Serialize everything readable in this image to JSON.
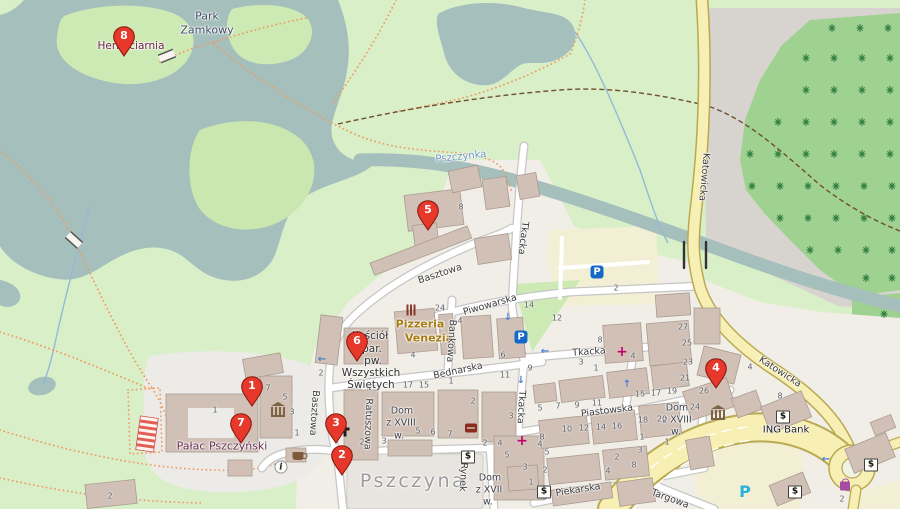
{
  "map": {
    "town": "Pszczyna",
    "colors": {
      "water": "#a5bfbc",
      "park": "#d8efc8",
      "island": "#cdeab4",
      "scrub": "#c9e7ae",
      "forest": "#9fd191",
      "tree": "#2e7b3f",
      "bare_gray": "#d7d3ce",
      "town_bg": "#f1eee8",
      "building": "#d0c0b6",
      "road_white": "#ffffff",
      "road_casing": "#c6c6c6",
      "road_main": "#f7efb4",
      "road_main_casing": "#b9a94f",
      "parking_lot": "#f3efd5",
      "square": "#e8e5e0",
      "marker_red": "#e6392b",
      "path_dotted": "#ef9b62",
      "path_dashed": "#6f4f2f"
    },
    "markers": [
      {
        "number": "1",
        "x": 252,
        "y": 407,
        "name": "map-marker-1"
      },
      {
        "number": "2",
        "x": 342,
        "y": 476,
        "name": "map-marker-2"
      },
      {
        "number": "3",
        "x": 336,
        "y": 444,
        "name": "map-marker-3"
      },
      {
        "number": "4",
        "x": 716,
        "y": 389,
        "name": "map-marker-4"
      },
      {
        "number": "5",
        "x": 428,
        "y": 231,
        "name": "map-marker-5"
      },
      {
        "number": "6",
        "x": 357,
        "y": 362,
        "name": "map-marker-6"
      },
      {
        "number": "7",
        "x": 241,
        "y": 444,
        "name": "map-marker-7"
      },
      {
        "number": "8",
        "x": 124,
        "y": 57,
        "name": "map-marker-8"
      }
    ],
    "street_labels": [
      {
        "text": "Basztowa",
        "x": 440,
        "y": 274,
        "rotate": -18
      },
      {
        "text": "Basztowa",
        "x": 314,
        "y": 413,
        "rotate": 94
      },
      {
        "text": "Ratuszowa",
        "x": 368,
        "y": 424,
        "rotate": 92
      },
      {
        "text": "Bednarska",
        "x": 458,
        "y": 371,
        "rotate": -12
      },
      {
        "text": "Bankowa",
        "x": 451,
        "y": 341,
        "rotate": 94
      },
      {
        "text": "Piwowarska",
        "x": 490,
        "y": 305,
        "rotate": -16
      },
      {
        "text": "Tkacka",
        "x": 523,
        "y": 238,
        "rotate": 97
      },
      {
        "text": "Tkacka",
        "x": 589,
        "y": 352,
        "rotate": -4
      },
      {
        "text": "Tkacka",
        "x": 521,
        "y": 407,
        "rotate": 93
      },
      {
        "text": "Piastowska",
        "x": 607,
        "y": 411,
        "rotate": -7
      },
      {
        "text": "Piekarska",
        "x": 578,
        "y": 490,
        "rotate": -9
      },
      {
        "text": "Rynek",
        "x": 463,
        "y": 477,
        "rotate": 93
      },
      {
        "text": "Targowa",
        "x": 670,
        "y": 499,
        "rotate": 20
      },
      {
        "text": "Katowicka",
        "x": 704,
        "y": 177,
        "rotate": 95
      },
      {
        "text": "Katowicka",
        "x": 780,
        "y": 372,
        "rotate": 33
      }
    ],
    "place_labels": [
      {
        "text": "Park",
        "x": 207,
        "y": 16,
        "color": "#414d68",
        "size": 11
      },
      {
        "text": "Zamkowy",
        "x": 207,
        "y": 30,
        "color": "#414d68",
        "size": 11
      },
      {
        "text": "Herbaciarnia",
        "x": 131,
        "y": 46,
        "color": "#6e2245",
        "size": 10.5
      },
      {
        "text": "Pszczynka",
        "x": 461,
        "y": 157,
        "color": "#6f96c2",
        "size": 10,
        "rotate": -6
      },
      {
        "text": "Pizzeria",
        "x": 420,
        "y": 324,
        "color": "#a87b10",
        "size": 11,
        "bold": true
      },
      {
        "text": "Venezia",
        "x": 429,
        "y": 338,
        "color": "#a87b10",
        "size": 11,
        "bold": true
      },
      {
        "text": "Kościół",
        "x": 370,
        "y": 336,
        "color": "#2f2f2f",
        "size": 10.5
      },
      {
        "text": "par.",
        "x": 372,
        "y": 349,
        "color": "#2f2f2f",
        "size": 10.5
      },
      {
        "text": "pw.",
        "x": 373,
        "y": 361,
        "color": "#2f2f2f",
        "size": 10.5
      },
      {
        "text": "Wszystkich",
        "x": 371,
        "y": 373,
        "color": "#2f2f2f",
        "size": 10.5
      },
      {
        "text": "Świętych",
        "x": 371,
        "y": 385,
        "color": "#2f2f2f",
        "size": 10.5
      },
      {
        "text": "Pałac Pszczyński",
        "x": 222,
        "y": 446,
        "color": "#692c4e",
        "size": 11
      },
      {
        "text": "Dom",
        "x": 402,
        "y": 411,
        "color": "#3d3d46",
        "size": 9.5
      },
      {
        "text": "z XVIII",
        "x": 401,
        "y": 423,
        "color": "#3d3d46",
        "size": 9.5
      },
      {
        "text": "w.",
        "x": 399,
        "y": 436,
        "color": "#3d3d46",
        "size": 9.5
      },
      {
        "text": "Dom",
        "x": 677,
        "y": 408,
        "color": "#3d3d46",
        "size": 9.5
      },
      {
        "text": "z XVIII",
        "x": 677,
        "y": 420,
        "color": "#3d3d46",
        "size": 9.5
      },
      {
        "text": "w.",
        "x": 676,
        "y": 432,
        "color": "#3d3d46",
        "size": 9.5
      },
      {
        "text": "Dom",
        "x": 490,
        "y": 478,
        "color": "#3d3d46",
        "size": 9.5
      },
      {
        "text": "z XVII",
        "x": 489,
        "y": 490,
        "color": "#3d3d46",
        "size": 9.5
      },
      {
        "text": "w.",
        "x": 488,
        "y": 502,
        "color": "#3d3d46",
        "size": 9.5
      },
      {
        "text": "ING Bank",
        "x": 786,
        "y": 430,
        "color": "#1a1a1a",
        "size": 10
      },
      {
        "text": "Pszczyna",
        "x": 413,
        "y": 481,
        "color": "#9b9b9b",
        "size": 19,
        "ls": 2.5
      }
    ],
    "house_numbers": [
      {
        "text": "8",
        "x": 461,
        "y": 207
      },
      {
        "text": "24",
        "x": 440,
        "y": 308
      },
      {
        "text": "14",
        "x": 529,
        "y": 305
      },
      {
        "text": "12",
        "x": 557,
        "y": 318
      },
      {
        "text": "2",
        "x": 616,
        "y": 288
      },
      {
        "text": "8",
        "x": 600,
        "y": 340
      },
      {
        "text": "3",
        "x": 581,
        "y": 362
      },
      {
        "text": "1",
        "x": 596,
        "y": 368
      },
      {
        "text": "4",
        "x": 460,
        "y": 321
      },
      {
        "text": "6",
        "x": 503,
        "y": 355
      },
      {
        "text": "9",
        "x": 530,
        "y": 368
      },
      {
        "text": "11",
        "x": 505,
        "y": 375
      },
      {
        "text": "4",
        "x": 413,
        "y": 355
      },
      {
        "text": "27",
        "x": 683,
        "y": 327
      },
      {
        "text": "25",
        "x": 687,
        "y": 343
      },
      {
        "text": "23",
        "x": 688,
        "y": 362
      },
      {
        "text": "21",
        "x": 685,
        "y": 378
      },
      {
        "text": "15",
        "x": 640,
        "y": 394
      },
      {
        "text": "17",
        "x": 656,
        "y": 393
      },
      {
        "text": "19",
        "x": 672,
        "y": 391
      },
      {
        "text": "18",
        "x": 643,
        "y": 420
      },
      {
        "text": "20",
        "x": 662,
        "y": 419
      },
      {
        "text": "24",
        "x": 695,
        "y": 407
      },
      {
        "text": "26",
        "x": 704,
        "y": 391
      },
      {
        "text": "2",
        "x": 720,
        "y": 362
      },
      {
        "text": "4",
        "x": 750,
        "y": 367
      },
      {
        "text": "8",
        "x": 780,
        "y": 396
      },
      {
        "text": "4",
        "x": 633,
        "y": 356
      },
      {
        "text": "17",
        "x": 408,
        "y": 385
      },
      {
        "text": "15",
        "x": 424,
        "y": 385
      },
      {
        "text": "1",
        "x": 451,
        "y": 381
      },
      {
        "text": "2",
        "x": 473,
        "y": 401
      },
      {
        "text": "3",
        "x": 511,
        "y": 416
      },
      {
        "text": "2",
        "x": 362,
        "y": 442
      },
      {
        "text": "3",
        "x": 384,
        "y": 441
      },
      {
        "text": "5",
        "x": 418,
        "y": 431
      },
      {
        "text": "6",
        "x": 433,
        "y": 432
      },
      {
        "text": "7",
        "x": 450,
        "y": 434
      },
      {
        "text": "2",
        "x": 321,
        "y": 373
      },
      {
        "text": "5",
        "x": 540,
        "y": 408
      },
      {
        "text": "7",
        "x": 558,
        "y": 406
      },
      {
        "text": "9",
        "x": 577,
        "y": 405
      },
      {
        "text": "11",
        "x": 597,
        "y": 403
      },
      {
        "text": "10",
        "x": 567,
        "y": 429
      },
      {
        "text": "12",
        "x": 584,
        "y": 428
      },
      {
        "text": "14",
        "x": 601,
        "y": 427
      },
      {
        "text": "16",
        "x": 617,
        "y": 426
      },
      {
        "text": "8",
        "x": 542,
        "y": 437
      },
      {
        "text": "5",
        "x": 547,
        "y": 452
      },
      {
        "text": "3",
        "x": 640,
        "y": 450
      },
      {
        "text": "1",
        "x": 667,
        "y": 442
      },
      {
        "text": "2",
        "x": 617,
        "y": 457
      },
      {
        "text": "4",
        "x": 608,
        "y": 471
      },
      {
        "text": "8",
        "x": 634,
        "y": 465
      },
      {
        "text": "9",
        "x": 545,
        "y": 497
      },
      {
        "text": "2",
        "x": 485,
        "y": 443
      },
      {
        "text": "4",
        "x": 500,
        "y": 443
      },
      {
        "text": "5",
        "x": 507,
        "y": 455
      },
      {
        "text": "4",
        "x": 540,
        "y": 444
      },
      {
        "text": "3",
        "x": 525,
        "y": 467
      },
      {
        "text": "2",
        "x": 545,
        "y": 470
      },
      {
        "text": "1",
        "x": 531,
        "y": 482
      },
      {
        "text": "1",
        "x": 215,
        "y": 410
      },
      {
        "text": "7",
        "x": 268,
        "y": 388
      },
      {
        "text": "5",
        "x": 285,
        "y": 397
      },
      {
        "text": "3",
        "x": 292,
        "y": 412
      },
      {
        "text": "1",
        "x": 297,
        "y": 433
      },
      {
        "text": "2",
        "x": 110,
        "y": 496
      },
      {
        "text": "1",
        "x": 642,
        "y": 437
      },
      {
        "text": "2",
        "x": 842,
        "y": 499
      }
    ],
    "poi_icons": [
      {
        "cls": "parking",
        "glyph": "P",
        "x": 597,
        "y": 272,
        "name": "parking-icon"
      },
      {
        "cls": "parking",
        "glyph": "P",
        "x": 521,
        "y": 337,
        "name": "parking-icon"
      },
      {
        "cls": "parking-free",
        "glyph": "P",
        "x": 745,
        "y": 492,
        "name": "free-parking-icon"
      },
      {
        "cls": "bank",
        "glyph": "$",
        "x": 783,
        "y": 417,
        "name": "bank-icon"
      },
      {
        "cls": "bank",
        "glyph": "$",
        "x": 468,
        "y": 457,
        "name": "bank-icon"
      },
      {
        "cls": "bank",
        "glyph": "$",
        "x": 544,
        "y": 492,
        "name": "bank-icon"
      },
      {
        "cls": "bank",
        "glyph": "$",
        "x": 795,
        "y": 492,
        "name": "atm-icon"
      },
      {
        "cls": "bank",
        "glyph": "$",
        "x": 871,
        "y": 465,
        "name": "atm-icon"
      },
      {
        "cls": "pharmacy",
        "glyph": "+",
        "x": 522,
        "y": 441,
        "name": "pharmacy-icon"
      },
      {
        "cls": "pharmacy",
        "glyph": "+",
        "x": 622,
        "y": 352,
        "name": "pharmacy-icon"
      },
      {
        "cls": "info",
        "glyph": "i",
        "x": 281,
        "y": 467,
        "name": "information-icon"
      },
      {
        "cls": "cafe",
        "x": 298,
        "y": 456,
        "name": "cafe-icon"
      },
      {
        "cls": "museum",
        "x": 278,
        "y": 408,
        "name": "museum-icon"
      },
      {
        "cls": "museum",
        "x": 718,
        "y": 411,
        "name": "museum-icon"
      },
      {
        "cls": "restaurant",
        "x": 411,
        "y": 310,
        "name": "restaurant-icon"
      },
      {
        "cls": "cross",
        "x": 345,
        "y": 431,
        "name": "church-cross-icon"
      },
      {
        "cls": "book",
        "x": 471,
        "y": 428,
        "name": "library-icon"
      },
      {
        "cls": "shop",
        "x": 845,
        "y": 486,
        "name": "shop-icon"
      },
      {
        "cls": "arrow",
        "glyph": "←",
        "x": 545,
        "y": 352,
        "name": "oneway-arrow-icon"
      },
      {
        "cls": "arrow",
        "glyph": "←",
        "x": 322,
        "y": 360,
        "name": "oneway-arrow-icon"
      },
      {
        "cls": "arrow",
        "glyph": "↓",
        "x": 508,
        "y": 318,
        "name": "oneway-arrow-icon"
      },
      {
        "cls": "arrow",
        "glyph": "↓",
        "x": 521,
        "y": 381,
        "name": "oneway-arrow-icon"
      },
      {
        "cls": "arrow",
        "glyph": "↑",
        "x": 627,
        "y": 385,
        "name": "oneway-arrow-icon"
      },
      {
        "cls": "arrow",
        "glyph": "←",
        "x": 826,
        "y": 460,
        "name": "oneway-arrow-icon"
      }
    ]
  }
}
